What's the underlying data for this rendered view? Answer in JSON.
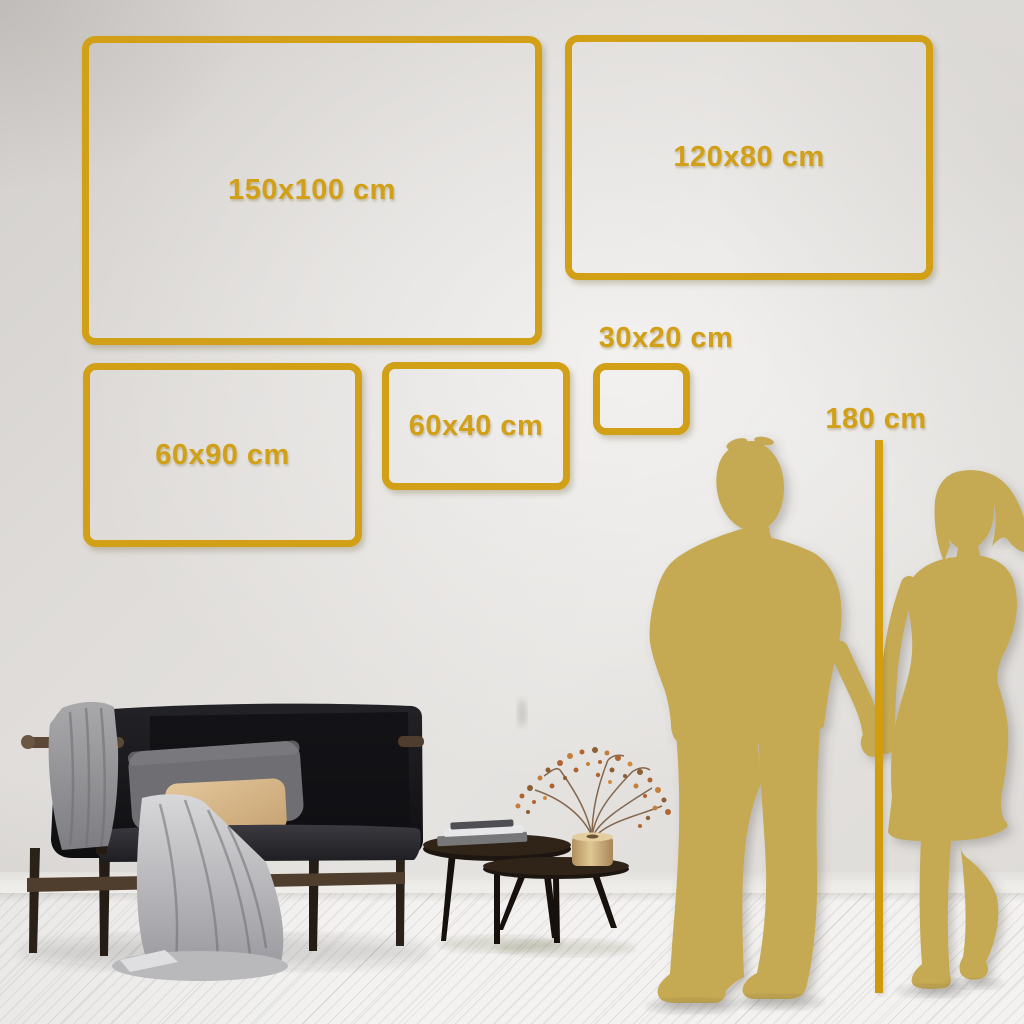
{
  "image": {
    "description": "Wall art size comparison guide shown on a living-room wall with sofa, coffee tables and a couple silhouette for scale",
    "kind": "size-guide"
  },
  "palette": {
    "accent_gold": "#D2A017",
    "silhouette_gold": "#C5A952",
    "wall": "#DEDBD8",
    "floor": "#F3F2F0"
  },
  "size_frames": [
    {
      "id": "150x100",
      "label": "150x100 cm",
      "width_cm": 150,
      "height_cm": 100
    },
    {
      "id": "120x80",
      "label": "120x80 cm",
      "width_cm": 120,
      "height_cm": 80
    },
    {
      "id": "60x90",
      "label": "60x90 cm",
      "width_cm": 60,
      "height_cm": 90
    },
    {
      "id": "60x40",
      "label": "60x40 cm",
      "width_cm": 60,
      "height_cm": 40
    },
    {
      "id": "30x20",
      "label": "30x20 cm",
      "width_cm": 30,
      "height_cm": 20
    }
  ],
  "height_marker": {
    "label": "180 cm",
    "value_cm": 180
  },
  "scene_objects": [
    "dark-velvet-sofa",
    "gray-throw-blanket",
    "gray-pillow",
    "beige-pillow",
    "nesting-coffee-tables",
    "book-stack",
    "brass-vase-dried-branch",
    "man-silhouette",
    "woman-silhouette",
    "white-plank-floor"
  ]
}
